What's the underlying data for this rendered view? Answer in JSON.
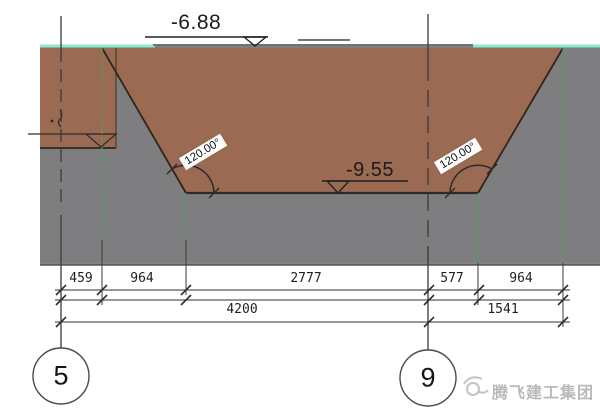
{
  "drawing": {
    "elevations": {
      "top": "-6.88",
      "bottom": "-9.55"
    },
    "angles": {
      "left": "120.00°",
      "right": "120.00°"
    },
    "dims_row1": [
      "459",
      "964",
      "2777",
      "577",
      "964"
    ],
    "dims_row2": [
      "4200",
      "1541"
    ],
    "grid": {
      "left_bubble": "5",
      "right_bubble": "9"
    },
    "watermark": "腾飞建工集团",
    "colors": {
      "soil_brown": "#9a6a53",
      "ground_gray": "#7e7e80",
      "surface_teal": "#8fe8c8",
      "guide_green": "#4d9f55",
      "line_dark": "#2f2f2f",
      "watermark_gray": "#b9b9b9"
    }
  }
}
